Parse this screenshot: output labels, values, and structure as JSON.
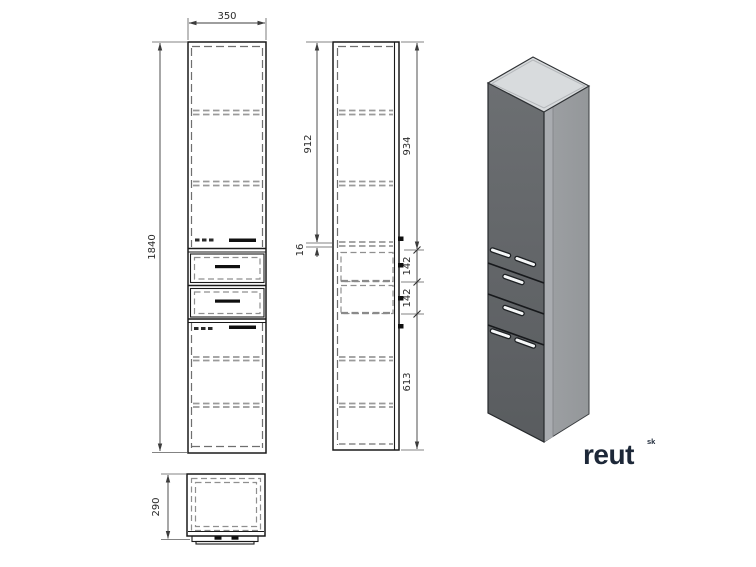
{
  "drawing": {
    "title": "tall-cabinet-technical-drawing",
    "dimensions": {
      "front_width": "350",
      "front_height": "1840",
      "side_left_upper": "912",
      "side_shelf_thickness": "16",
      "side_right_upper": "934",
      "side_drawer_a": "142",
      "side_drawer_b": "142",
      "side_lower": "613",
      "top_depth": "290"
    }
  },
  "brand": {
    "name": "reut",
    "superscript": "sk",
    "logo_color": "#1d2838"
  },
  "colors": {
    "background": "#ffffff",
    "drawing_line": "#1a1a1a",
    "hidden_line": "#8f8f8f",
    "dimension_line": "#3c3c3c",
    "render_front_face": "#64676a",
    "render_side_face": "#9b9ea1",
    "render_top_face": "#d8dbdd",
    "render_handle": "#f4f6f7"
  }
}
